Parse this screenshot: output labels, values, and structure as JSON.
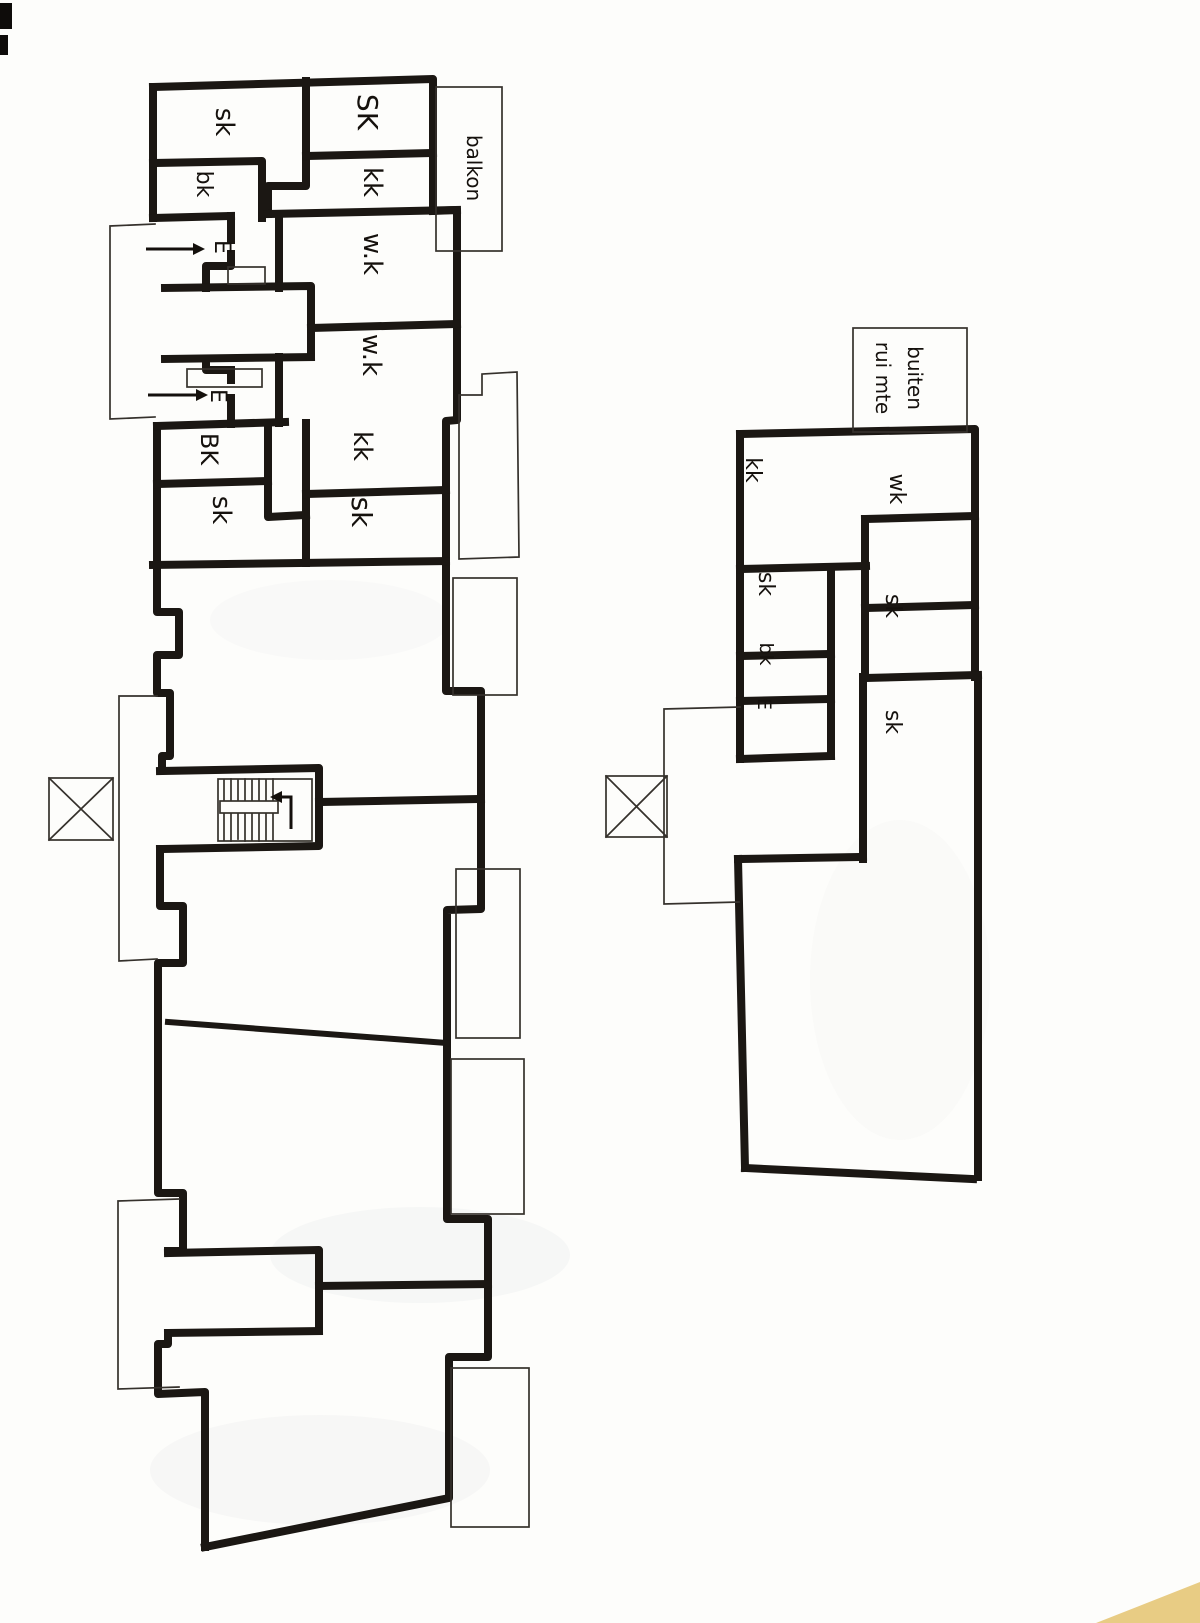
{
  "document": {
    "kind": "hand-drawn architectural floor plan scan",
    "buildings": 2
  },
  "colors": {
    "paper": "#fdfdfb",
    "wall_ink": "#1b1713",
    "thin_ink": "#35312c",
    "scan_corner": "#e8cc84"
  },
  "icons": {
    "elevator_shaft": "crossed-box",
    "entrance_arrow": "right-arrow",
    "stair_direction_arrow": "up-left-turn-arrow"
  },
  "labels": {
    "b1_sk_top": {
      "text": "sk"
    },
    "b1_bk_top": {
      "text": "bk"
    },
    "b1_SK_top": {
      "text": "SK"
    },
    "b1_kk_top": {
      "text": "kk"
    },
    "balkon": {
      "text": "balkon"
    },
    "b1_E_1": {
      "text": "E"
    },
    "b1_wk_1": {
      "text": "w.k"
    },
    "b1_wk_2": {
      "text": "w.k"
    },
    "b1_E_2": {
      "text": "E"
    },
    "b1_BK_2": {
      "text": "BK"
    },
    "b1_kk_2": {
      "text": "kk"
    },
    "b1_sk_2": {
      "text": "sk"
    },
    "b1_sk_3": {
      "text": "sk"
    },
    "buiten_line1": {
      "text": "buiten"
    },
    "buiten_line2": {
      "text": "rui mte"
    },
    "b2_kk": {
      "text": "kk"
    },
    "b2_wk": {
      "text": "wk"
    },
    "b2_sk_1": {
      "text": "sk"
    },
    "b2_sk_2": {
      "text": "sk"
    },
    "b2_bk": {
      "text": "bk"
    },
    "b2_E": {
      "text": "E"
    },
    "b2_sk_3": {
      "text": "sk"
    }
  }
}
